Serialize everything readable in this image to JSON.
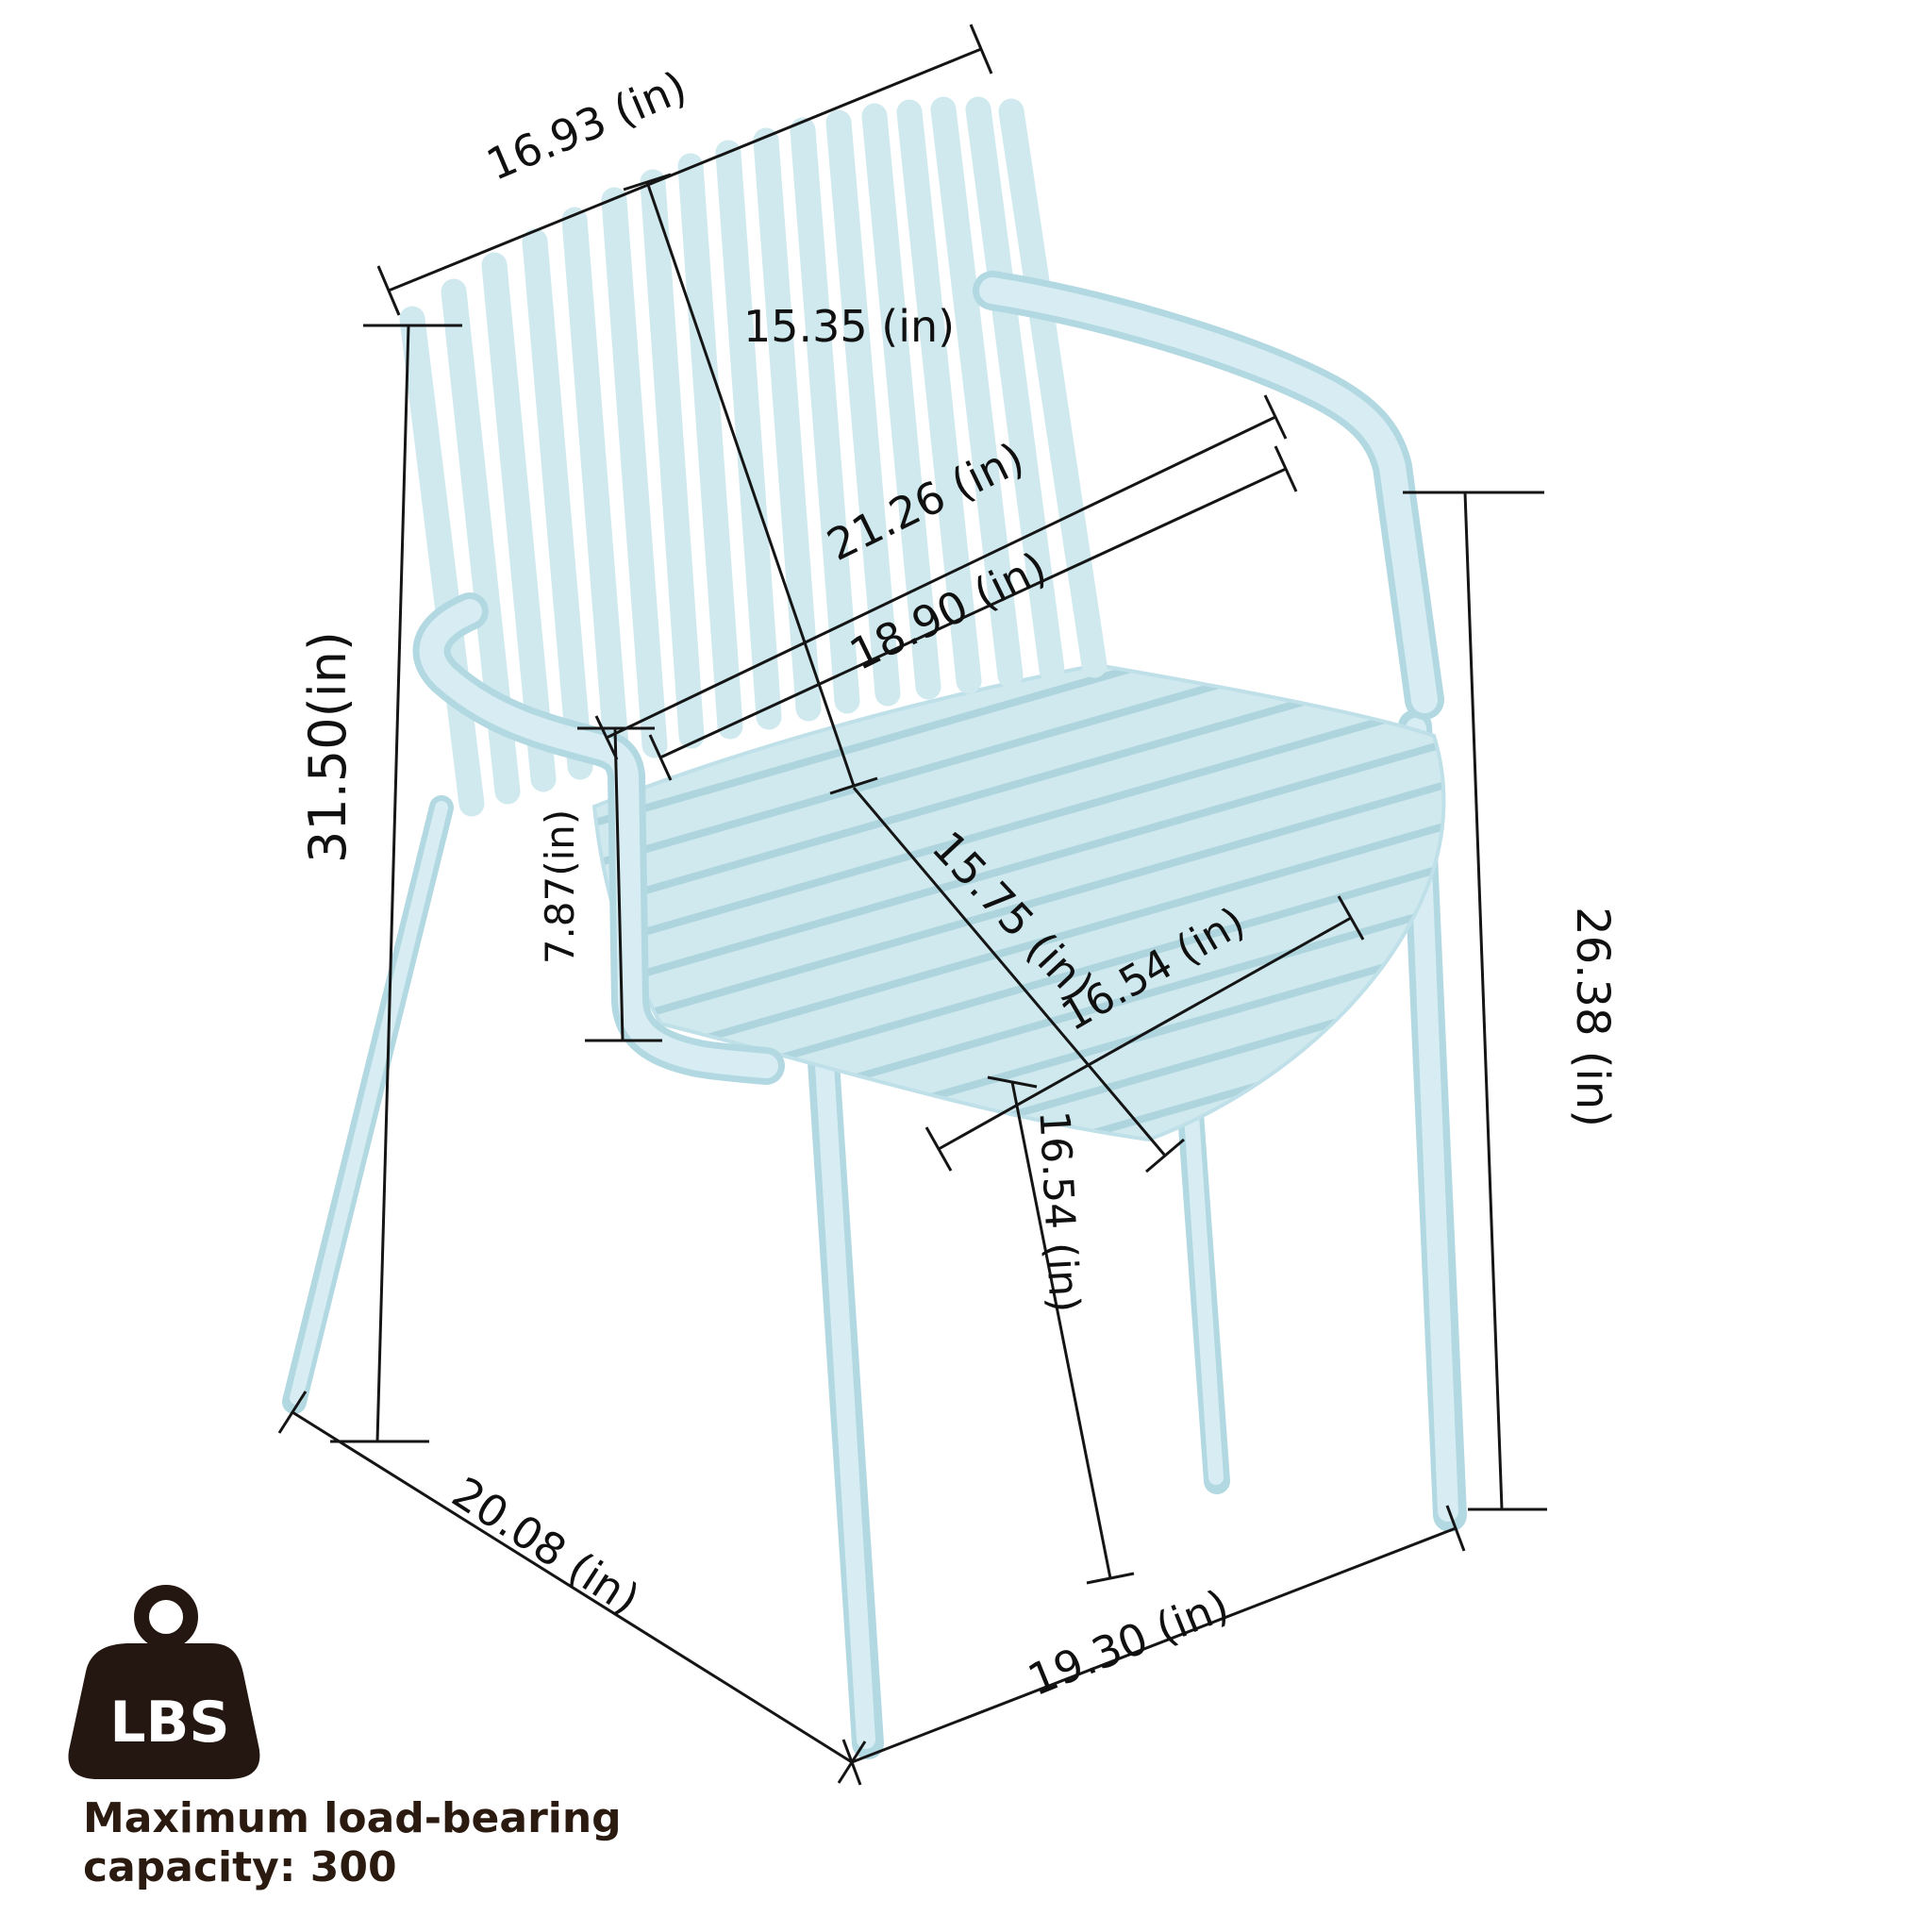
{
  "diagram": {
    "type": "product-dimension-diagram",
    "subject": "stackable plastic outdoor armchair, light blue",
    "unit": "in",
    "labels": {
      "back_top_width": "16.93 (in)",
      "backrest_height": "15.35 (in)",
      "overall_width": "21.26 (in)",
      "back_width": "18.90 (in)",
      "overall_height": "31.50(in)",
      "armrest_above_seat": "7.87(in)",
      "seat_depth": "15.75 (in)",
      "seat_width": "16.54 (in)",
      "armrest_floor_height": "26.38 (in)",
      "seat_height": "16.54 (in)",
      "total_depth": "20.08 (in)",
      "front_width": "19.30 (in)"
    },
    "dimensions_in": {
      "back_top_width": 16.93,
      "backrest_height": 15.35,
      "overall_width": 21.26,
      "back_width": 18.9,
      "overall_height": 31.5,
      "armrest_above_seat": 7.87,
      "seat_depth": 15.75,
      "seat_width": 16.54,
      "armrest_floor_height": 26.38,
      "seat_height": 16.54,
      "total_depth": 20.08,
      "front_width": 19.3
    },
    "colors": {
      "chair": "#cfe9ee",
      "chair_shade": "#b2d8e2",
      "chair_highlight": "#d7edf3",
      "dimension_lines": "#151515",
      "caption_text": "#2b1a10",
      "badge": "#241711"
    }
  },
  "load_badge": {
    "icon_label": "LBS",
    "caption_line1": "Maximum load-bearing",
    "caption_line2": "capacity: 300",
    "max_capacity": 300
  }
}
